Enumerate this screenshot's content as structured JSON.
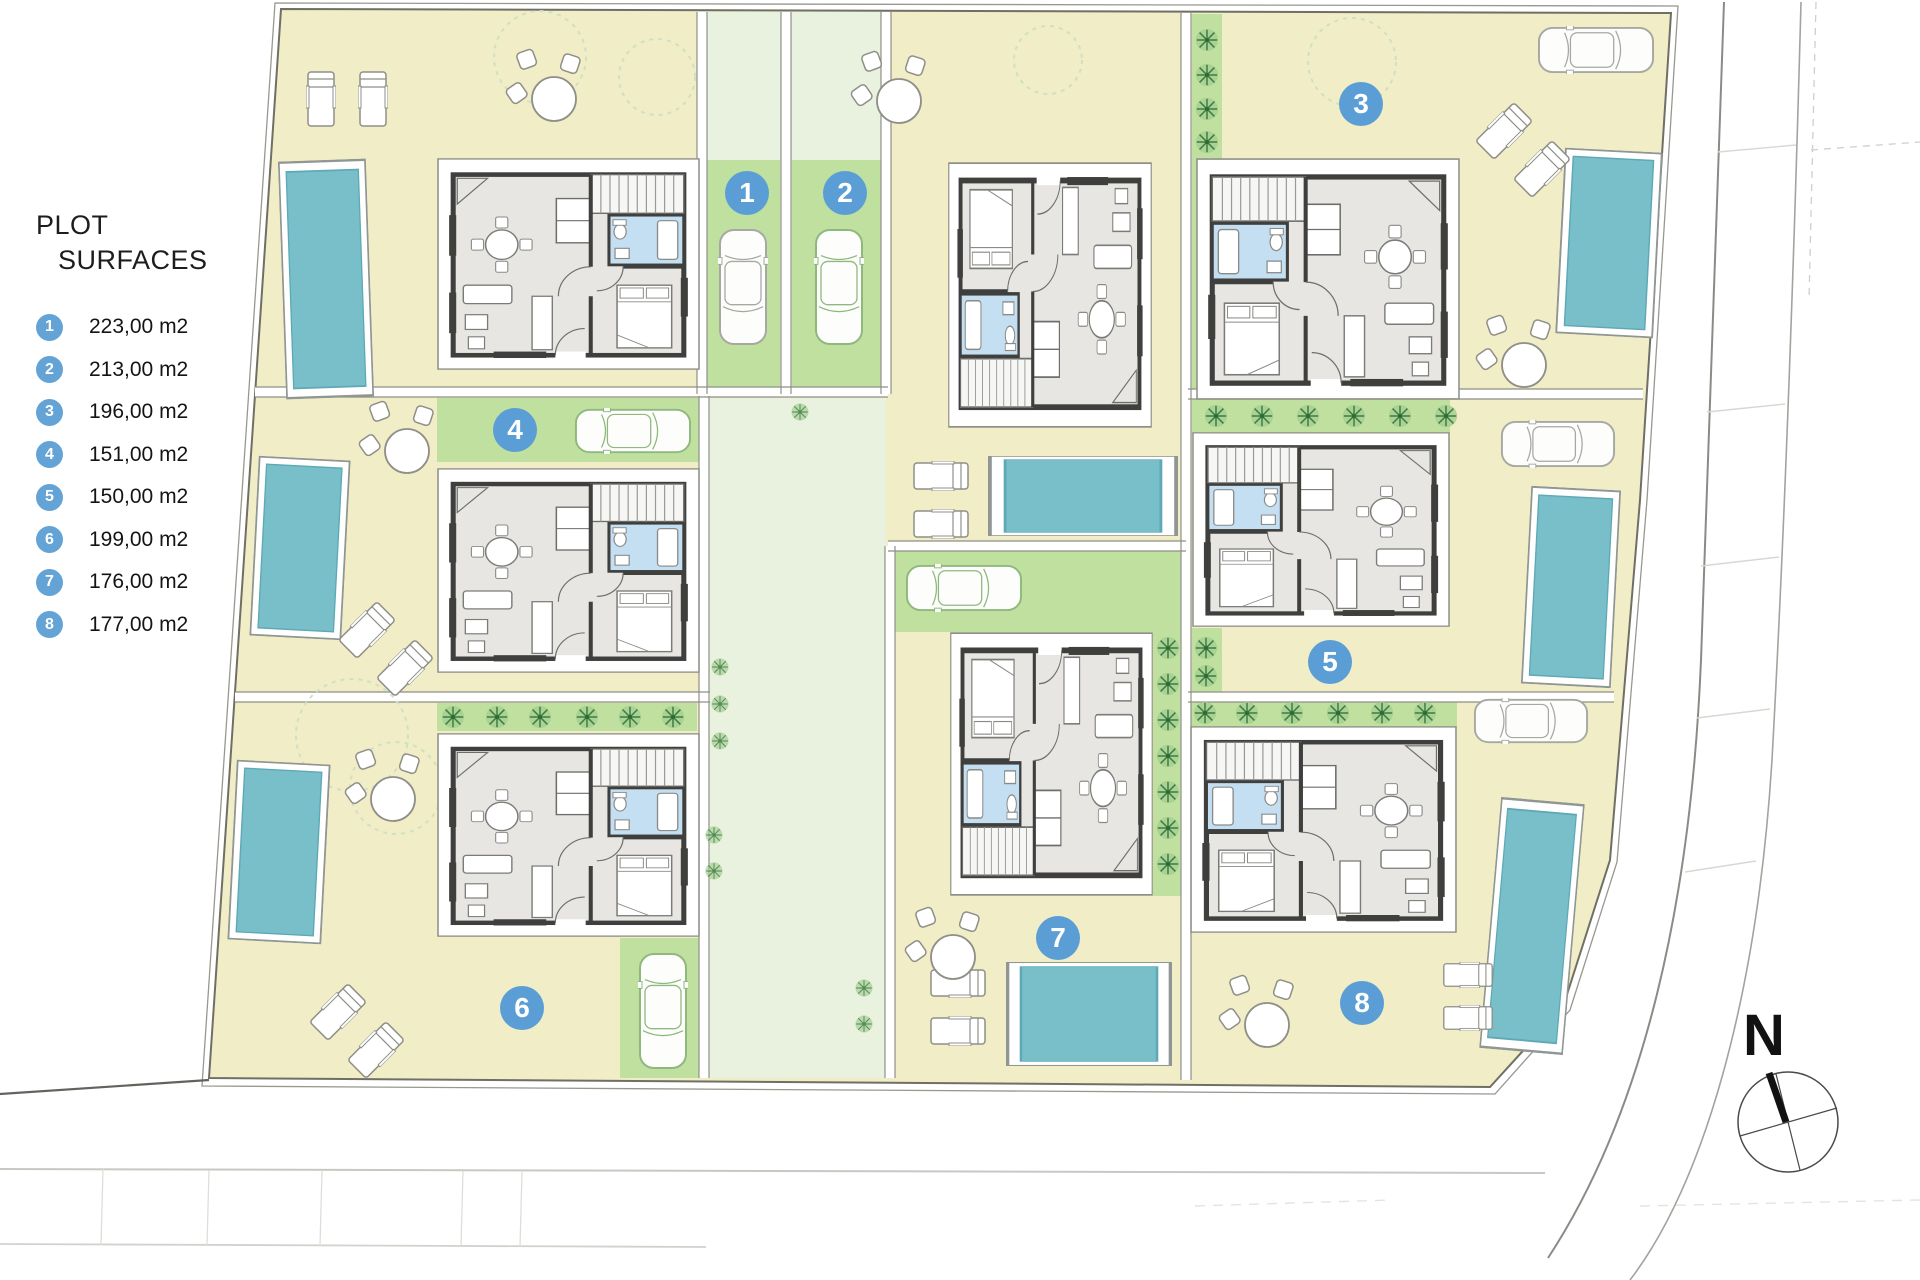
{
  "legend": {
    "title_line1": "PLOT",
    "title_line2": "SURFACES",
    "items": [
      {
        "num": "1",
        "area": "223,00 m2"
      },
      {
        "num": "2",
        "area": "213,00 m2"
      },
      {
        "num": "3",
        "area": "196,00 m2"
      },
      {
        "num": "4",
        "area": "151,00 m2"
      },
      {
        "num": "5",
        "area": "150,00 m2"
      },
      {
        "num": "6",
        "area": "199,00 m2"
      },
      {
        "num": "7",
        "area": "176,00 m2"
      },
      {
        "num": "8",
        "area": "177,00 m2"
      }
    ]
  },
  "badges": [
    {
      "label": "1"
    },
    {
      "label": "2"
    },
    {
      "label": "3"
    },
    {
      "label": "4"
    },
    {
      "label": "5"
    },
    {
      "label": "6"
    },
    {
      "label": "7"
    },
    {
      "label": "8"
    }
  ],
  "compass": {
    "north_label": "N"
  },
  "colors": {
    "badge_blue": "#5b9ed6",
    "plot_beige": "#f1edc6",
    "parking_green": "#c0e0a0",
    "path_green": "#e9f2df",
    "pool_teal": "#79bfc9",
    "bathroom_blue": "#c4def2",
    "house_gray": "#e7e6e3"
  }
}
